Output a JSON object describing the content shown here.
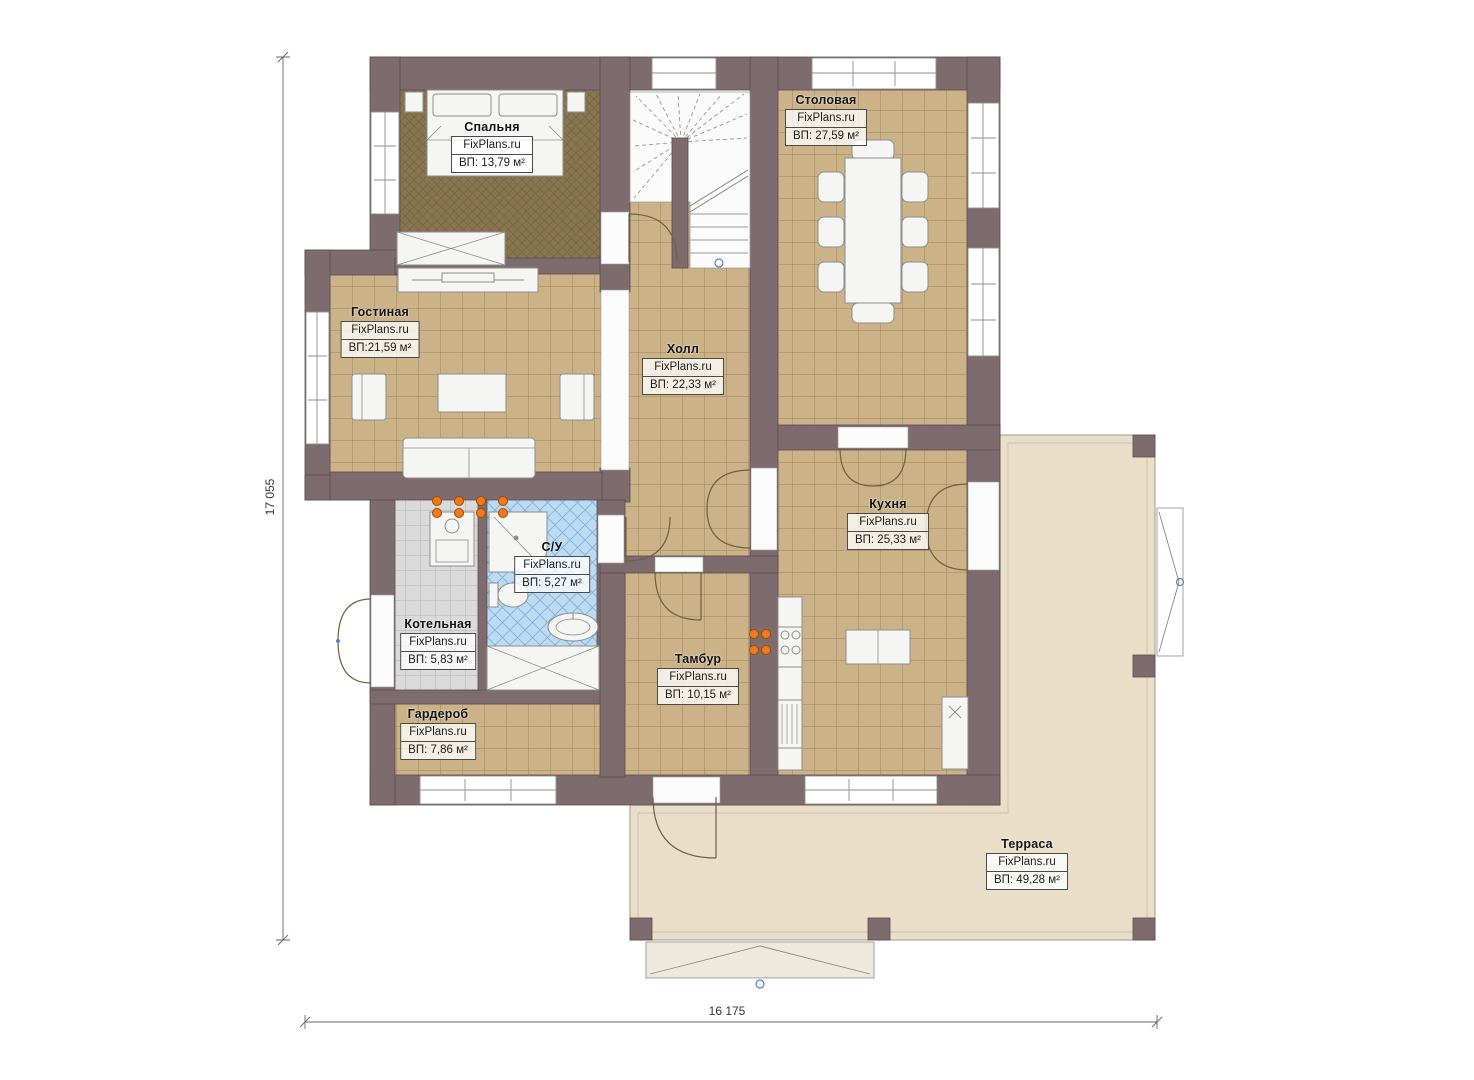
{
  "watermark": "FixPlans.ru",
  "dimensions": {
    "left": "17 055",
    "bottom": "16 175"
  },
  "rooms": [
    {
      "id": "bedroom",
      "name": "Спальня",
      "area": "ВП: 13,79 м²"
    },
    {
      "id": "dining",
      "name": "Столовая",
      "area": "ВП: 27,59 м²"
    },
    {
      "id": "living",
      "name": "Гостиная",
      "area": "ВП:21,59 м²"
    },
    {
      "id": "hall",
      "name": "Холл",
      "area": "ВП: 22,33 м²"
    },
    {
      "id": "kitchen",
      "name": "Кухня",
      "area": "ВП: 25,33 м²"
    },
    {
      "id": "bathroom",
      "name": "С/У",
      "area": "ВП: 5,27 м²"
    },
    {
      "id": "boiler",
      "name": "Котельная",
      "area": "ВП: 5,83 м²"
    },
    {
      "id": "vestibule",
      "name": "Тамбур",
      "area": "ВП: 10,15 м²"
    },
    {
      "id": "wardrobe",
      "name": "Гардероб",
      "area": "ВП: 7,86 м²"
    },
    {
      "id": "terrace",
      "name": "Терраса",
      "area": "ВП: 49,28 м²"
    }
  ],
  "colors": {
    "wall": "#7d6b6e",
    "floor_tile": "#cbb287",
    "bedroom_carpet": "#897650",
    "bathroom_tile": "#badbf4",
    "boiler_tile": "#dadada",
    "terrace_floor": "#e9dec8",
    "heating_accent": "#ee7a1c"
  }
}
